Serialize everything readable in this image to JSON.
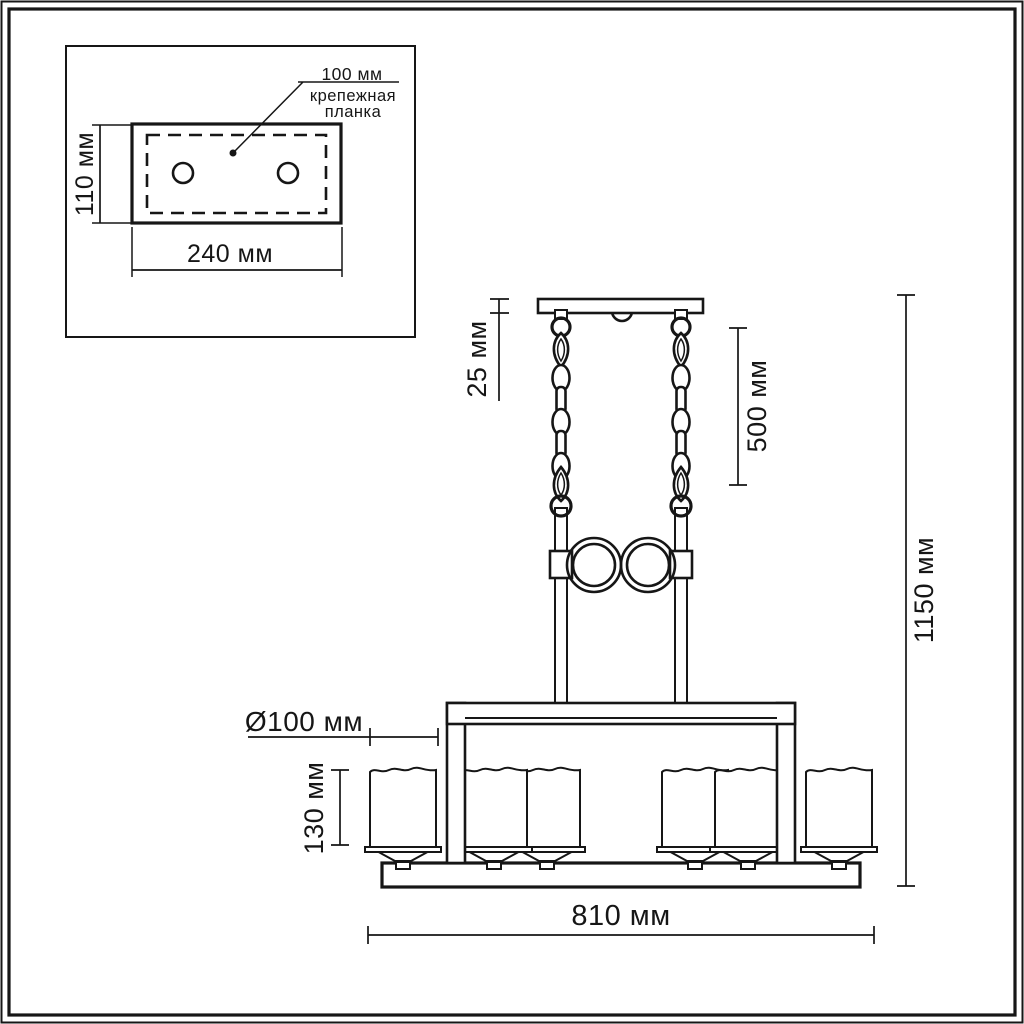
{
  "diagram": {
    "kind": "chandelier-dimension-drawing",
    "units": "мм",
    "line_color": "#161616",
    "background_color": "#ffffff",
    "shade_count": 6
  },
  "inset": {
    "spacing_label": "100 мм",
    "part_name_line1": "крепежная",
    "part_name_line2": "планка",
    "height_label": "110 мм",
    "width_label": "240 мм"
  },
  "fixture": {
    "canopy_height_label": "25 мм",
    "chain_length_label": "500 мм",
    "total_height_label": "1150 мм",
    "shade_diameter_label": "Ø100 мм",
    "shade_height_label": "130 мм",
    "total_width_label": "810 мм"
  }
}
